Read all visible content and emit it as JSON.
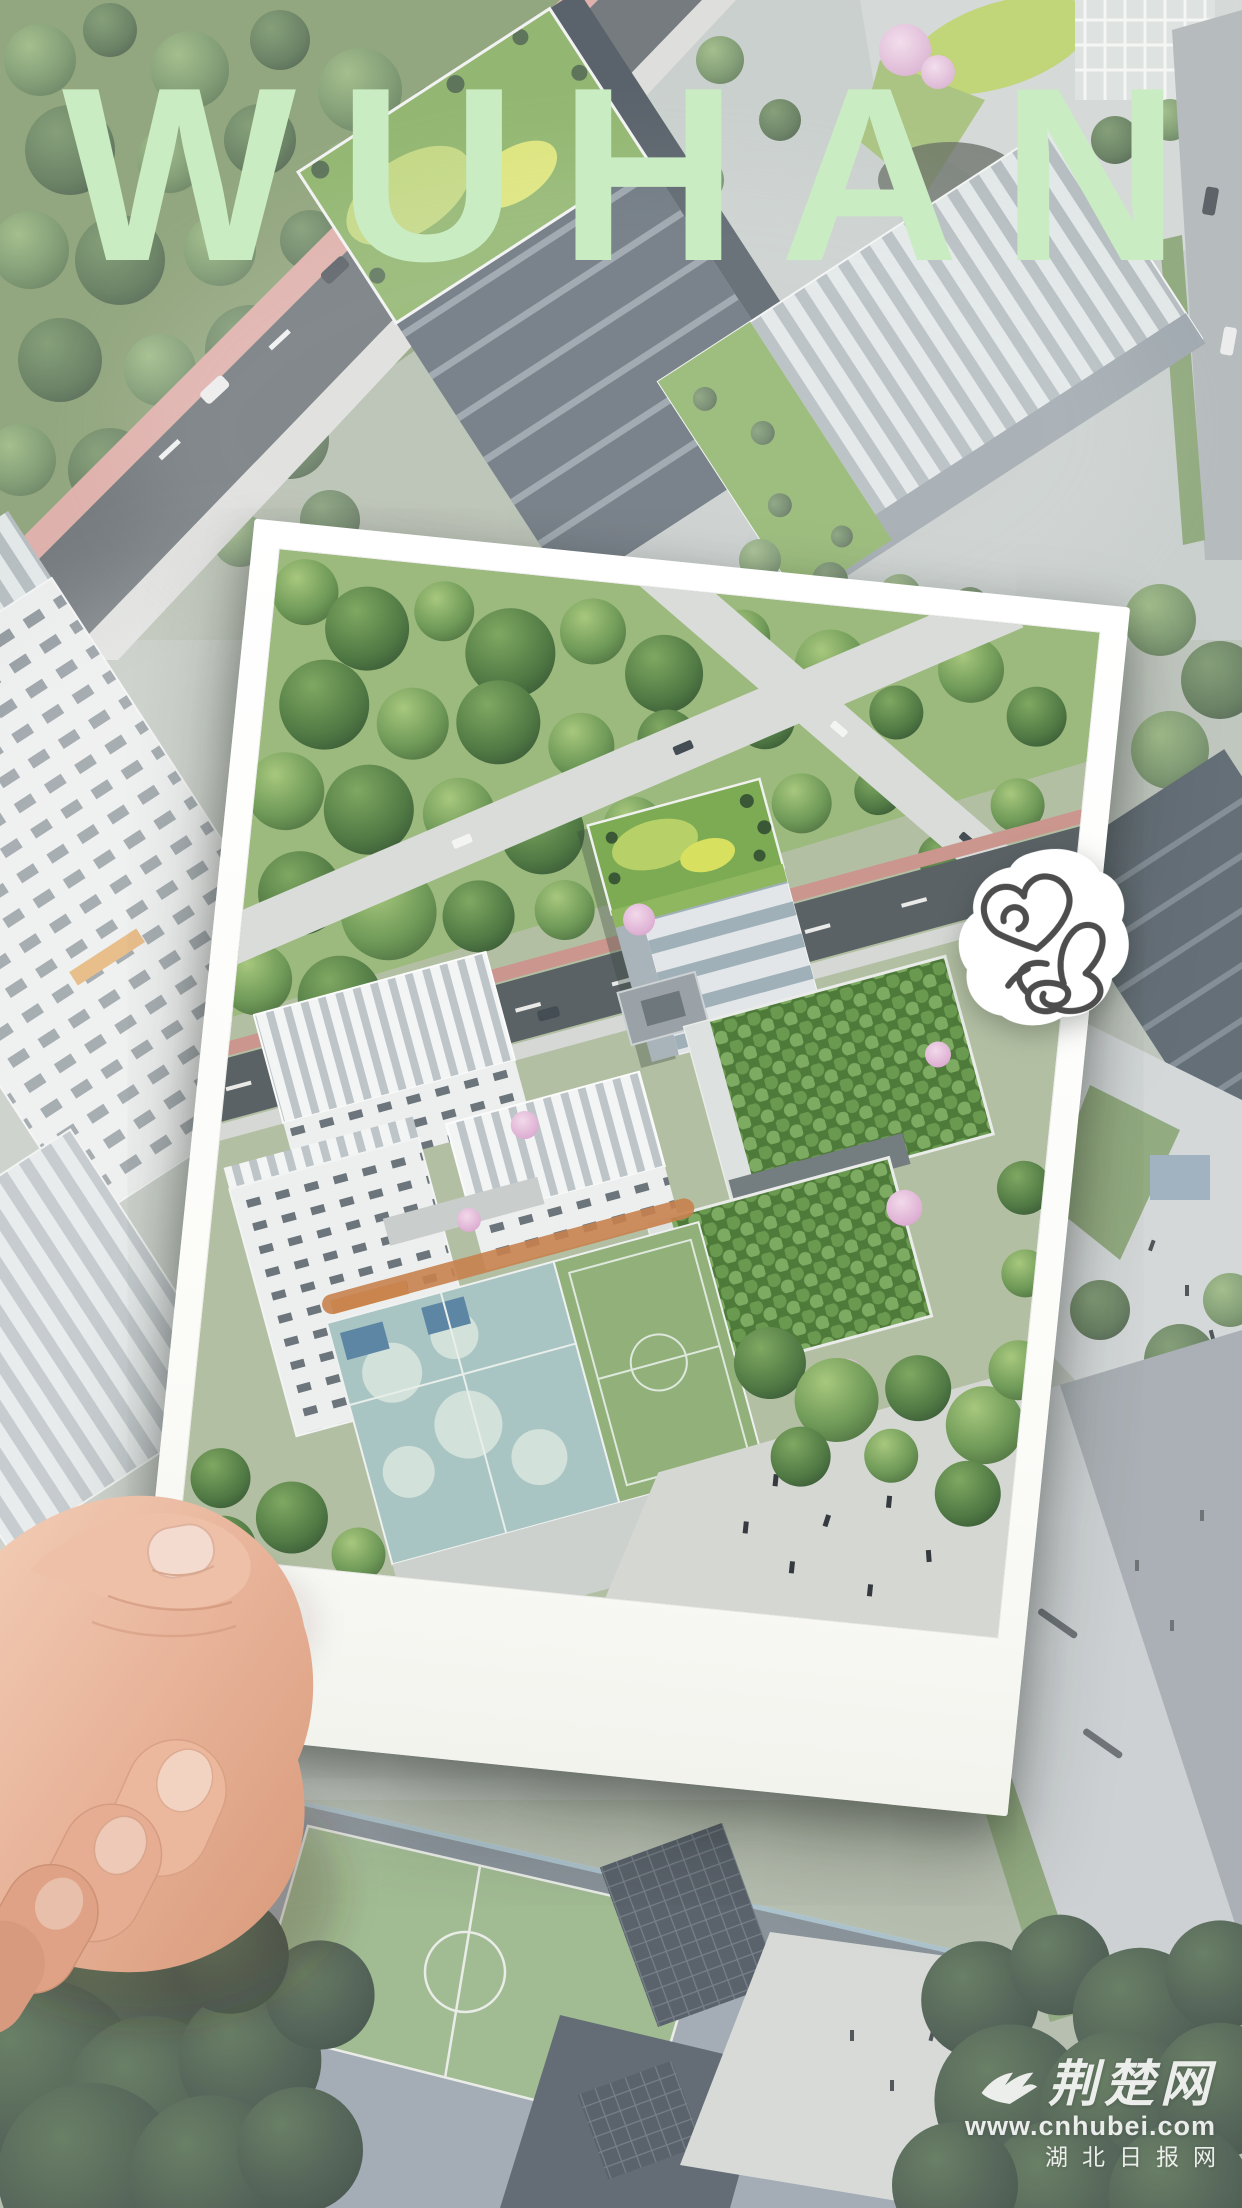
{
  "poster": {
    "title": "WUHAN",
    "title_color": "#caecc2"
  },
  "sticker": {
    "background": "#ffffff",
    "stroke": "#4d4d4d",
    "icons": [
      "heart-doodle-icon",
      "thumbs-up-doodle-icon"
    ]
  },
  "watermark": {
    "site_name": "荆楚网",
    "url": "www.cnhubei.com",
    "label_cn": "湖北日报网",
    "color": "#ffffff",
    "icon": "bird-logo-icon"
  },
  "palette": {
    "haze_white": "#ffffff",
    "foliage_green": "#67865a",
    "dark_foliage": "#3a4f38",
    "green_roof": "#7cab53",
    "bright_lawn": "#b5cd5e",
    "road_dark": "#5b6266",
    "road_light": "#d9dcd9",
    "sidewalk_pink": "#cb968e",
    "court_teal": "#a9c5c3",
    "field_green": "#91b07a",
    "track_orange": "#c8814e",
    "blossom_pink": "#d9a6ce",
    "polaroid_white": "#fcfcfa",
    "skin_tone": "#e7b298"
  }
}
